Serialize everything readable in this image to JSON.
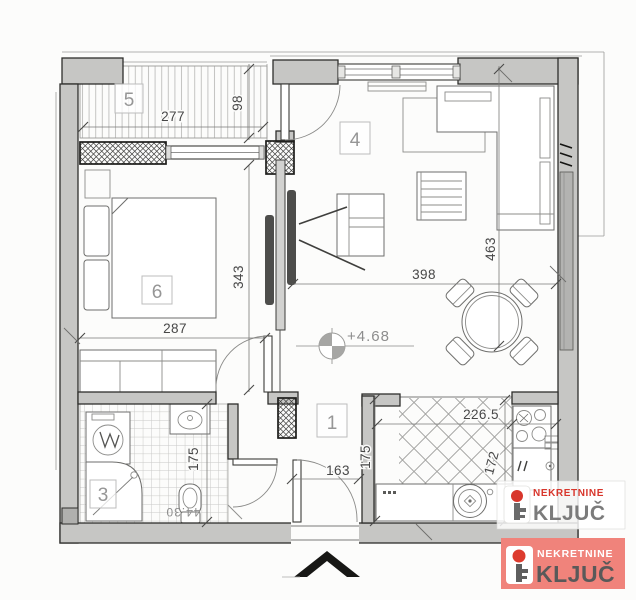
{
  "plan": {
    "room_labels": {
      "hall": "1",
      "bathroom": "3",
      "living": "4",
      "terrace": "5",
      "bedroom": "6"
    },
    "dims": {
      "terrace_w": "277",
      "terrace_d": "98",
      "bedroom_w": "287",
      "bedroom_d": "343",
      "living_w": "398",
      "living_d": "463",
      "hall_w": "163",
      "hall_d": "175",
      "bath_d": "175",
      "kitchen_w": "226.5",
      "kitchen_d": "172"
    },
    "elevation_label": "+4.68",
    "rotated_label": "44.30"
  },
  "branding": {
    "watermark": {
      "line1": "NEKRETNINE",
      "line2": "KLJUČ"
    },
    "badge": {
      "line1": "NEKRETNINE",
      "line2": "KLJUČ"
    }
  },
  "colors": {
    "wall": "#c6c6c4",
    "brand_red": "#d8362c",
    "badge_bg": "#f0837b",
    "brand_gray": "#6b6b6b"
  }
}
